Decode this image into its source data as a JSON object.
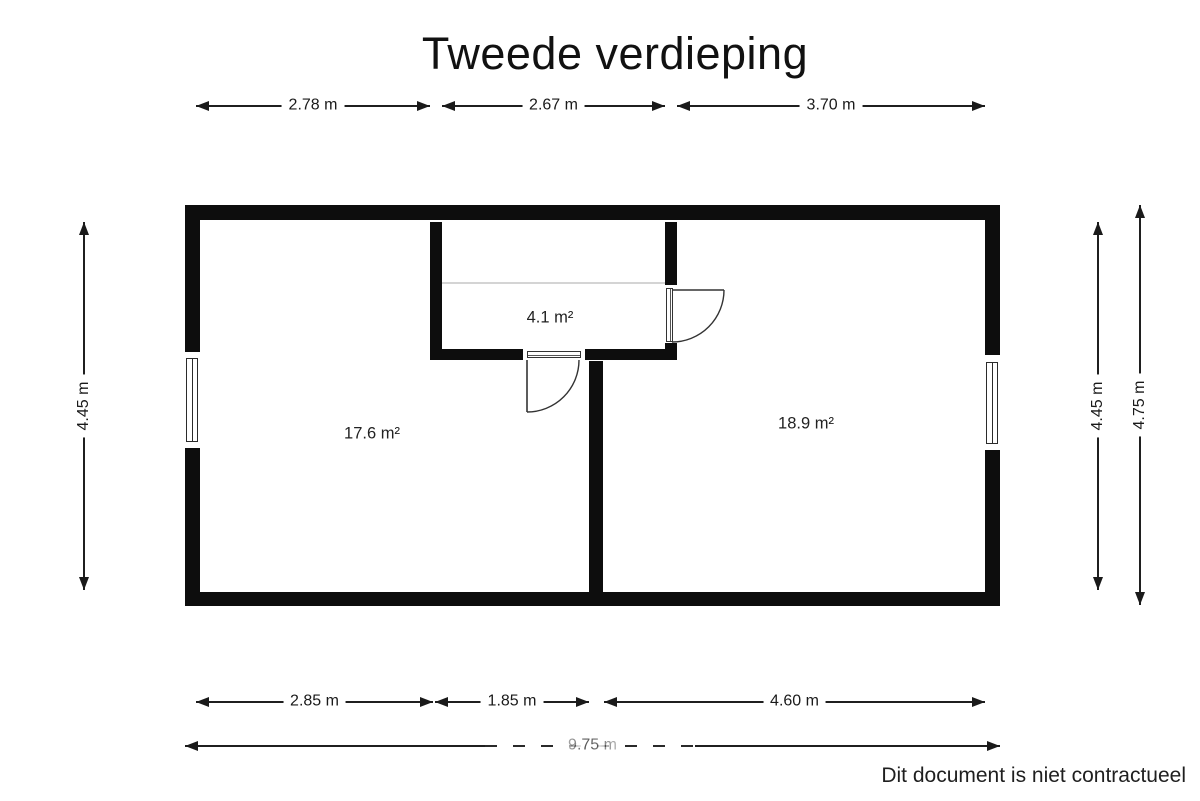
{
  "title": "Tweede verdieping",
  "footer_note": "Dit document is niet contractueel",
  "rooms": {
    "left_room_area": "17.6 m²",
    "small_room_area": "4.1 m²",
    "right_room_area": "18.9 m²"
  },
  "dimensions": {
    "top": [
      "2.78 m",
      "2.67 m",
      "3.70 m"
    ],
    "bottom": [
      "2.85 m",
      "1.85 m",
      "4.60 m"
    ],
    "total_width": "9.75 m",
    "left": [
      "4.45 m"
    ],
    "right": [
      "4.45 m",
      "4.75 m"
    ]
  },
  "colors": {
    "wall": "#0d0d0d",
    "dimension_line": "#1f1f1f",
    "ceiling_break_line": "#d4d4d4",
    "background": "#ffffff"
  }
}
